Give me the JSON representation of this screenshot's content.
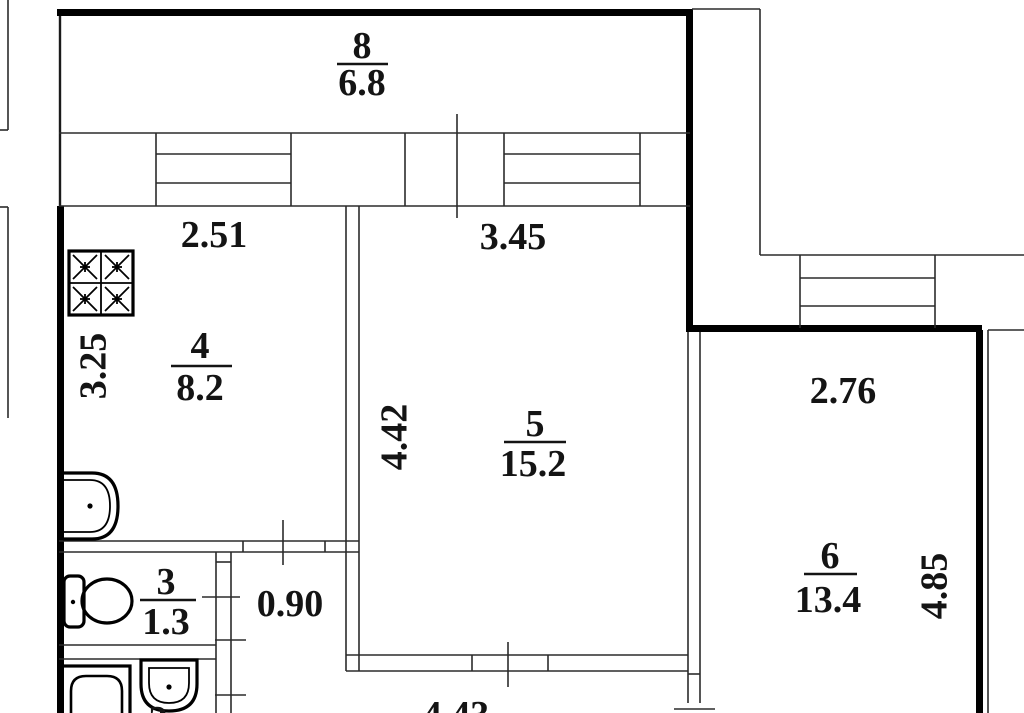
{
  "plan_title": "apartment floor plan",
  "rooms": {
    "balcony8": {
      "number": "8",
      "area": "6.8"
    },
    "kitchen4": {
      "number": "4",
      "area": "8.2"
    },
    "wc3": {
      "number": "3",
      "area": "1.3"
    },
    "bathroom2": {
      "number_partial": "2"
    },
    "living5": {
      "number": "5",
      "area": "15.2"
    },
    "bedroom6": {
      "number": "6",
      "area": "13.4"
    }
  },
  "dimensions": {
    "kitchen_width": "2.51",
    "kitchen_depth": "3.25",
    "living_width": "3.45",
    "living_depth": "4.42",
    "living_bottom_width": "4.43",
    "door_opening": "0.90",
    "bedroom_width": "2.76",
    "bedroom_depth": "4.85"
  },
  "colors": {
    "line": "#1a1a1a",
    "wall": "#000000",
    "background": "#ffffff"
  }
}
